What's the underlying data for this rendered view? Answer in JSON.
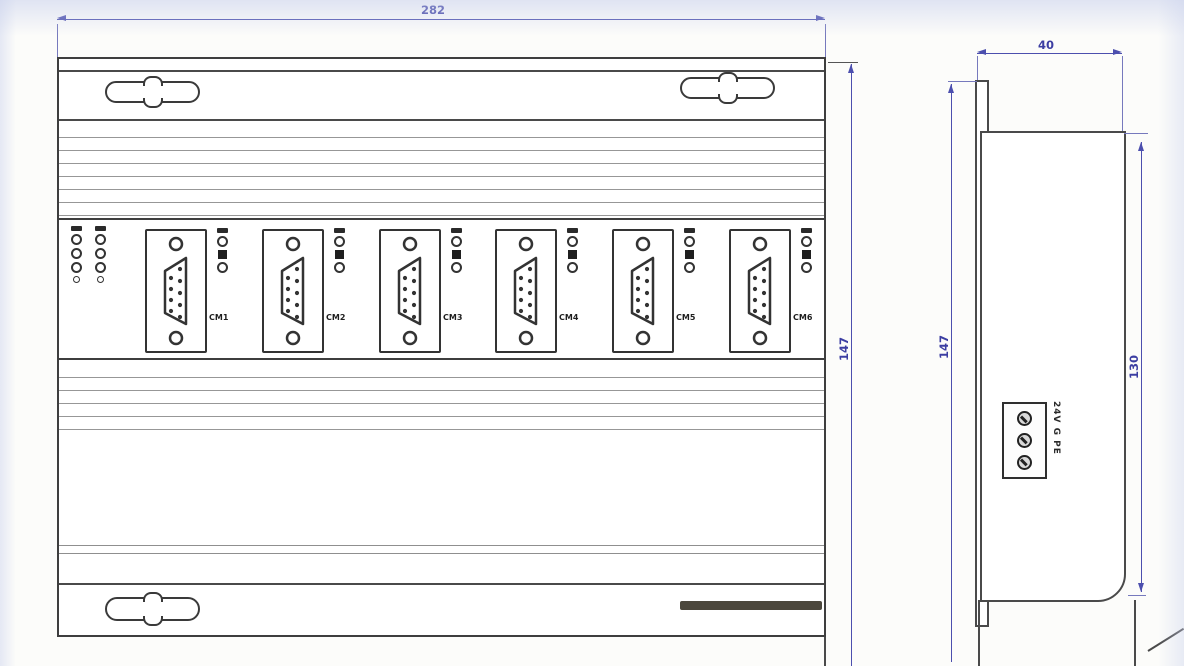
{
  "drawing": {
    "front_view": {
      "width_dim": "282",
      "height_dim": "147",
      "ports": [
        {
          "label": "CM1"
        },
        {
          "label": "CM2"
        },
        {
          "label": "CM3"
        },
        {
          "label": "CM4"
        },
        {
          "label": "CM5"
        },
        {
          "label": "CM6"
        }
      ]
    },
    "side_view": {
      "depth_dim": "40",
      "height_dim": "147",
      "body_height_dim": "130",
      "terminal_label": "24V G PE"
    },
    "colors": {
      "dimension_blue": "#4c4fae",
      "line_dark": "#3e3e3e"
    }
  }
}
